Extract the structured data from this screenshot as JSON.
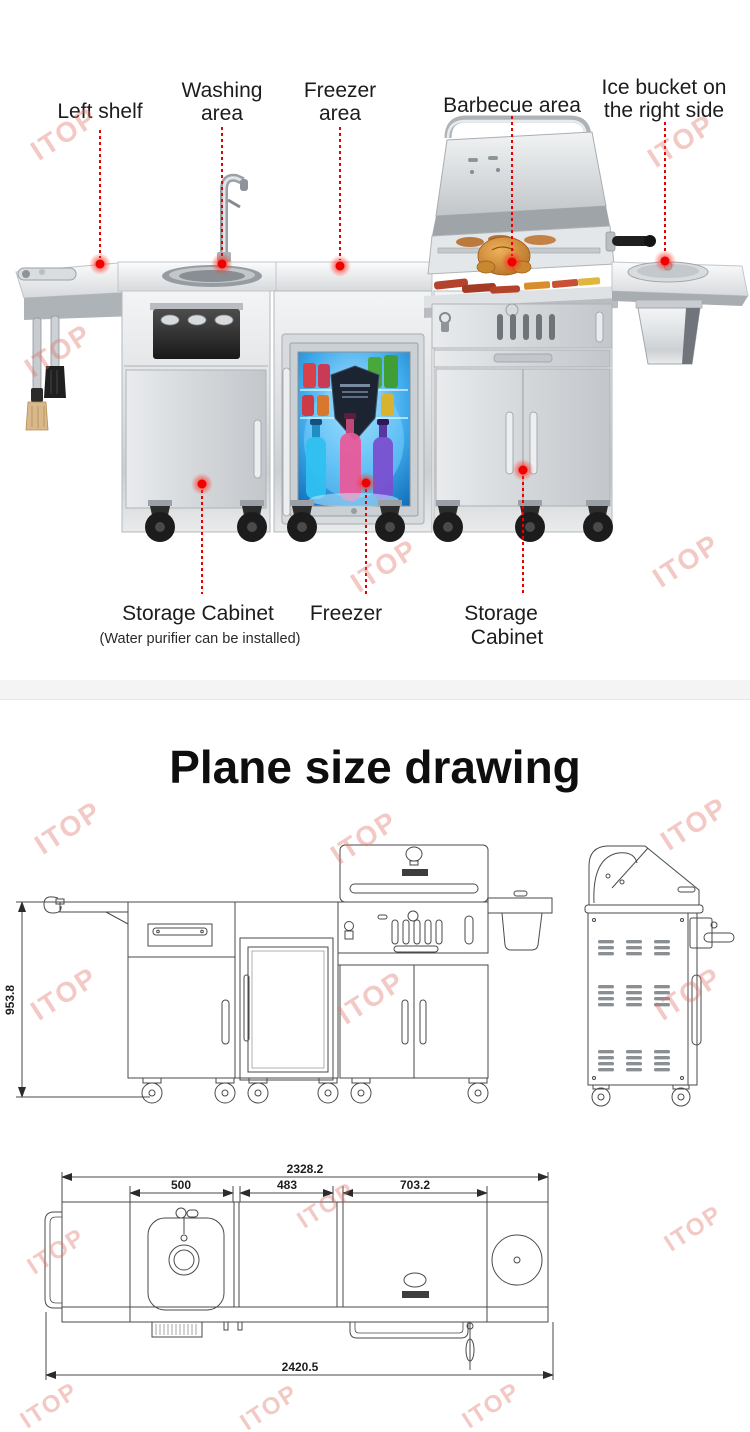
{
  "watermark": {
    "text": "ITOP"
  },
  "annotations": {
    "left_shelf": "Left shelf",
    "washing1": "Washing",
    "washing2": "area",
    "freezer_area1": "Freezer",
    "freezer_area2": "area",
    "barbecue": "Barbecue area",
    "ice1": "Ice bucket on",
    "ice2": "the right side",
    "storage_left": "Storage Cabinet",
    "storage_left_note": "(Water purifier can be installed)",
    "freezer": "Freezer",
    "storage_right1": "Storage",
    "storage_right2": "Cabinet"
  },
  "section2": {
    "title": "Plane size drawing"
  },
  "dimensions": {
    "height": "953.8",
    "overall_top": "2328.2",
    "seg_a": "500",
    "seg_b": "483",
    "seg_c": "703.2",
    "overall_bottom": "2420.5"
  },
  "colors": {
    "accent_red": "#e60000",
    "watermark_pink": "#de7064"
  }
}
